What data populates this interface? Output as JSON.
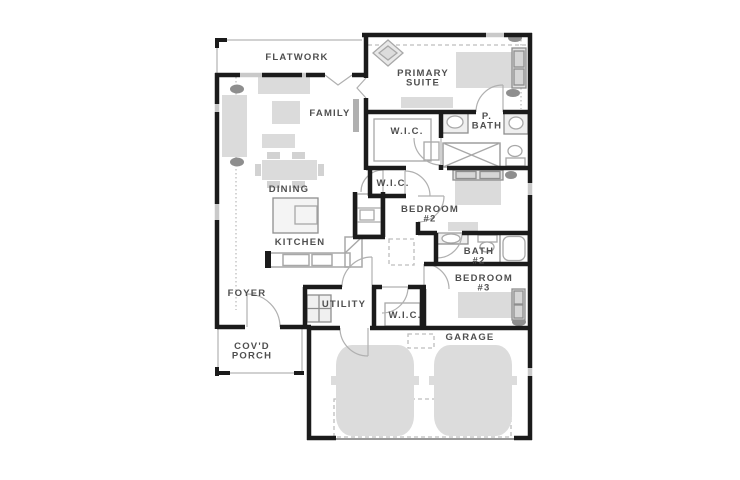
{
  "page": {
    "title": "Residential Floor Plan"
  },
  "palette": {
    "wall": "#1b1b1b",
    "window": "#c9c9c9",
    "furniture_fill": "#dbdbdb",
    "furniture_dark": "#8e8e8e",
    "fixture_line": "#a8a8a8",
    "thin_line": "#c2c2c2",
    "dashed_line": "#bdbdbd",
    "label_text": "#4f4f4f",
    "background": "#ffffff"
  },
  "rooms": [
    {
      "id": "flatwork",
      "lines": [
        "FLATWORK"
      ],
      "x": 297,
      "y": 60
    },
    {
      "id": "primary-suite",
      "lines": [
        "PRIMARY",
        "SUITE"
      ],
      "x": 423,
      "y": 76
    },
    {
      "id": "family",
      "lines": [
        "FAMILY"
      ],
      "x": 330,
      "y": 116
    },
    {
      "id": "wic-primary",
      "lines": [
        "W.I.C."
      ],
      "x": 407,
      "y": 134
    },
    {
      "id": "p-bath",
      "lines": [
        "P.",
        "BATH"
      ],
      "x": 487,
      "y": 119
    },
    {
      "id": "wic-hall",
      "lines": [
        "W.I.C."
      ],
      "x": 393,
      "y": 186
    },
    {
      "id": "dining",
      "lines": [
        "DINING"
      ],
      "x": 289,
      "y": 192
    },
    {
      "id": "bedroom-2",
      "lines": [
        "BEDROOM",
        "#2"
      ],
      "x": 430,
      "y": 212
    },
    {
      "id": "kitchen",
      "lines": [
        "KITCHEN"
      ],
      "x": 300,
      "y": 245
    },
    {
      "id": "bath-2",
      "lines": [
        "BATH",
        "#2"
      ],
      "x": 479,
      "y": 254
    },
    {
      "id": "bedroom-3",
      "lines": [
        "BEDROOM",
        "#3"
      ],
      "x": 484,
      "y": 281
    },
    {
      "id": "foyer",
      "lines": [
        "FOYER"
      ],
      "x": 247,
      "y": 296
    },
    {
      "id": "utility",
      "lines": [
        "UTILITY"
      ],
      "x": 344,
      "y": 307
    },
    {
      "id": "wic-bedroom3",
      "lines": [
        "W.I.C."
      ],
      "x": 405,
      "y": 318
    },
    {
      "id": "covd-porch",
      "lines": [
        "COV'D",
        "PORCH"
      ],
      "x": 252,
      "y": 349
    },
    {
      "id": "garage",
      "lines": [
        "GARAGE"
      ],
      "x": 470,
      "y": 340
    }
  ]
}
